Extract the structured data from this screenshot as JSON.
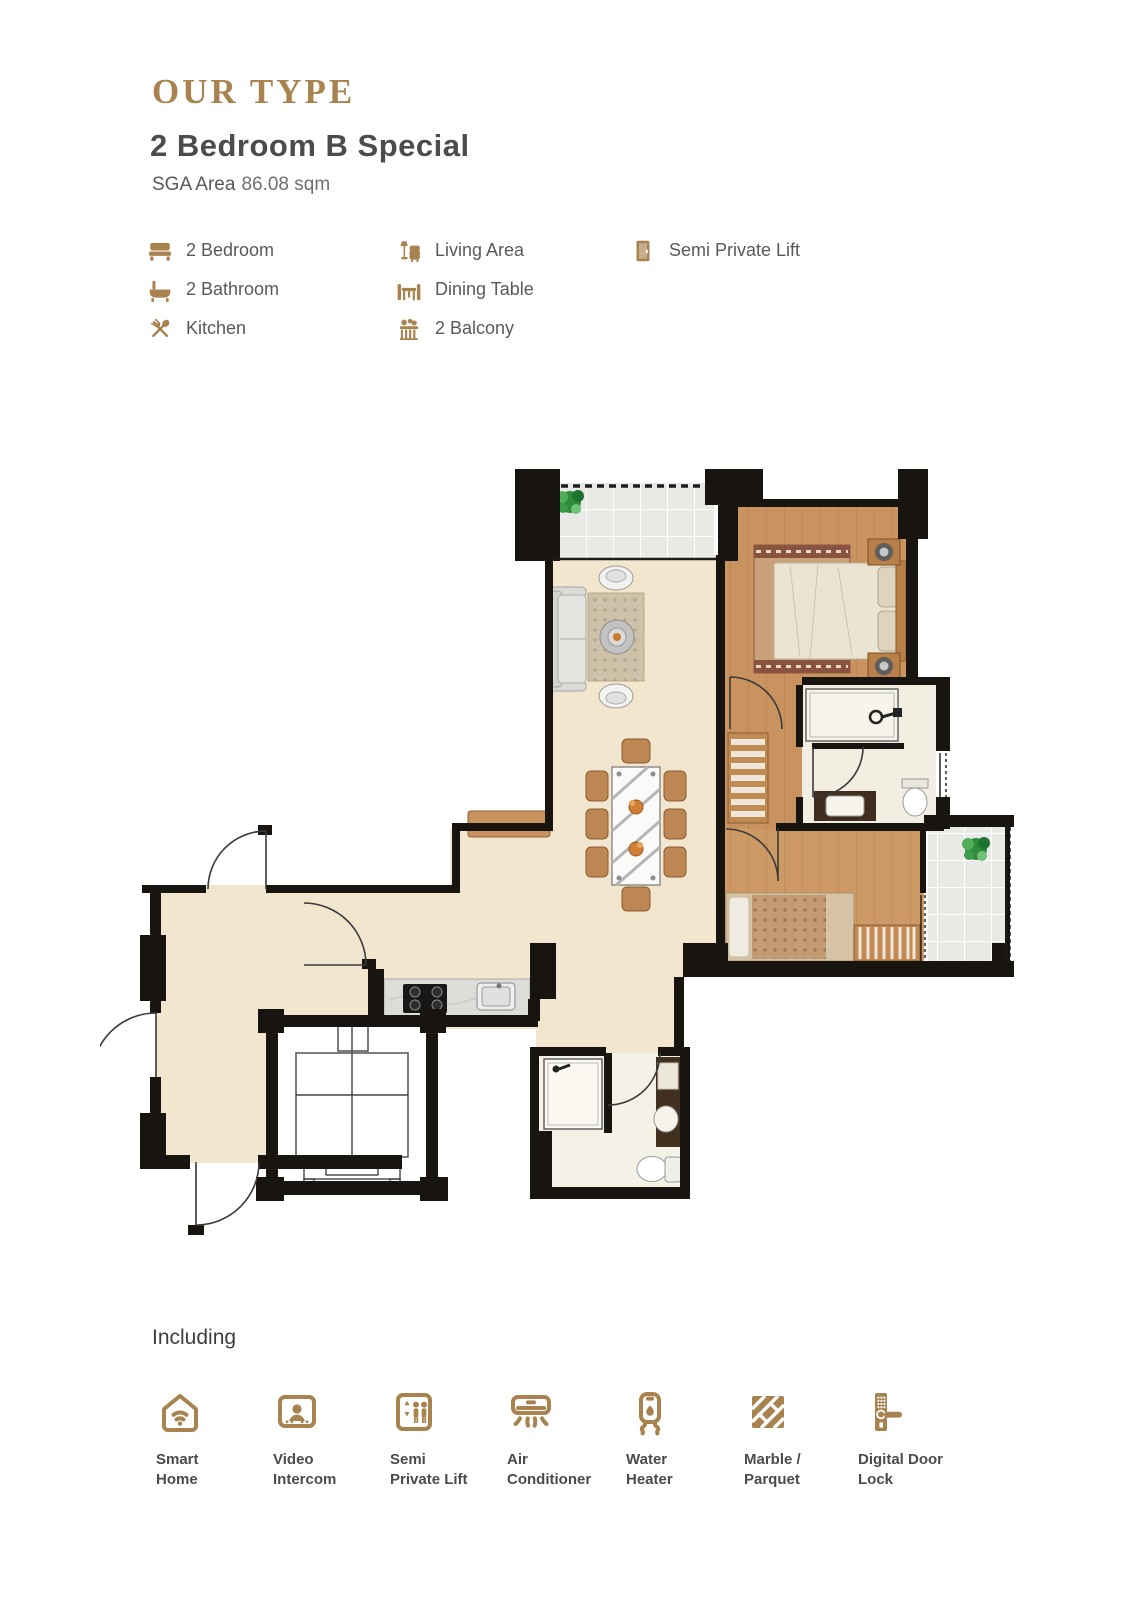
{
  "header": {
    "eyebrow": "OUR TYPE",
    "title": "2 Bedroom B Special",
    "area_label": "SGA Area",
    "area_value": "86.08 sqm"
  },
  "features": {
    "col1": [
      {
        "icon": "bed-icon",
        "label": "2 Bedroom"
      },
      {
        "icon": "bathtub-icon",
        "label": "2 Bathroom"
      },
      {
        "icon": "kitchen-icon",
        "label": "Kitchen"
      }
    ],
    "col2": [
      {
        "icon": "living-area-icon",
        "label": "Living Area"
      },
      {
        "icon": "dining-table-icon",
        "label": "Dining Table"
      },
      {
        "icon": "balcony-icon",
        "label": "2 Balcony"
      }
    ],
    "col3": [
      {
        "icon": "lift-door-icon",
        "label": "Semi Private Lift"
      }
    ]
  },
  "including": {
    "heading": "Including",
    "items": [
      {
        "icon": "smart-home-icon",
        "lines": [
          "Smart",
          "Home"
        ]
      },
      {
        "icon": "video-intercom-icon",
        "lines": [
          "Video",
          "Intercom"
        ]
      },
      {
        "icon": "semi-private-lift-icon",
        "lines": [
          "Semi",
          "Private Lift"
        ]
      },
      {
        "icon": "air-conditioner-icon",
        "lines": [
          "Air",
          "Conditioner"
        ]
      },
      {
        "icon": "water-heater-icon",
        "lines": [
          "Water",
          "Heater"
        ]
      },
      {
        "icon": "marble-parquet-icon",
        "lines": [
          "Marble /",
          "Parquet"
        ]
      },
      {
        "icon": "digital-door-lock-icon",
        "lines": [
          "Digital Door",
          "Lock"
        ]
      }
    ]
  },
  "colors": {
    "gold": "#A8834F",
    "title_text": "#4B4C4E",
    "body_text": "#58595B",
    "muted_text": "#6F7072",
    "wall": "#181410",
    "floor_marble": "#F2E7CE",
    "floor_wood": "#C8935F",
    "floor_wood2": "#CD9A66",
    "balcony_tile": "#E9E9E6",
    "bath_floor": "#F2EEE1",
    "furniture_tan": "#BD8753",
    "counter_gray": "#DCDCD8"
  }
}
